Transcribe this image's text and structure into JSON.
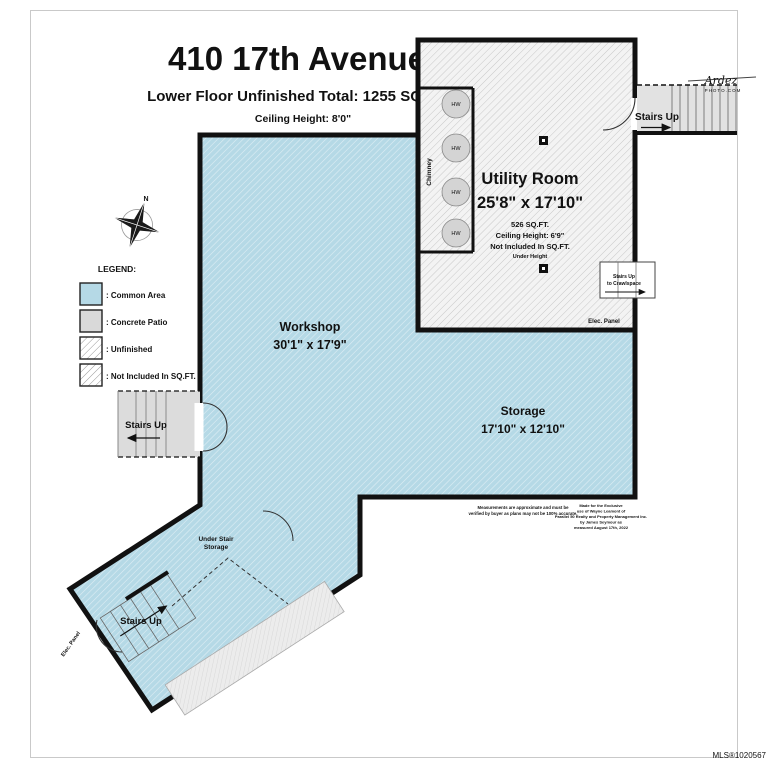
{
  "page": {
    "title": "410 17th Avenue",
    "subtitle": "Lower Floor Unfinished Total: 1255 SQ.FT.",
    "ceiling_height": "Ceiling Height: 8'0\""
  },
  "legend": {
    "heading": "LEGEND:",
    "items": [
      {
        "label": ": Common Area",
        "color": "#b5d9e6"
      },
      {
        "label": ": Concrete Patio",
        "color": "#d9d9d9"
      },
      {
        "label": ": Unfinished"
      },
      {
        "label": ": Not Included In SQ.FT."
      }
    ]
  },
  "rooms": {
    "utility": {
      "name": "Utility Room",
      "dims": "25'8\" x 17'10\"",
      "area": "526 SQ.FT.",
      "ceiling": "Ceiling Height: 6'9\"",
      "note": "Not Included In SQ.FT.",
      "subnote": "Under Height"
    },
    "workshop": {
      "name": "Workshop",
      "dims": "30'1\" x 17'9\""
    },
    "storage": {
      "name": "Storage",
      "dims": "17'10\" x 12'10\""
    }
  },
  "labels": {
    "stairs_up": "Stairs Up",
    "to_crawlspace": "to Crawlspace",
    "under_stair_line1": "Under Stair",
    "under_stair_line2": "Storage",
    "elec_panel": "Elec. Panel",
    "chimney": "Chimney",
    "hw": "HW",
    "north": "N"
  },
  "watermark": {
    "brand": "Ardez",
    "domain": "PHOTO.COM"
  },
  "disclaimer": {
    "left": [
      "Measurements are approximate and must be",
      "verified by buyer as plans may not be 100% accurate."
    ],
    "right": [
      "Made for the Exclusive",
      "use of Wayne Leamont of",
      "Parallel 50 Realty and Property Management Inc.",
      "by James Seymour as",
      "measured August 17th, 2022"
    ]
  },
  "mls": "MLS®1020567",
  "colors": {
    "wall": "#111111",
    "common_area": "#b5d9e6",
    "concrete_patio": "#d9d9d9",
    "unfinished_hatch_line": "#c8c8c8"
  }
}
